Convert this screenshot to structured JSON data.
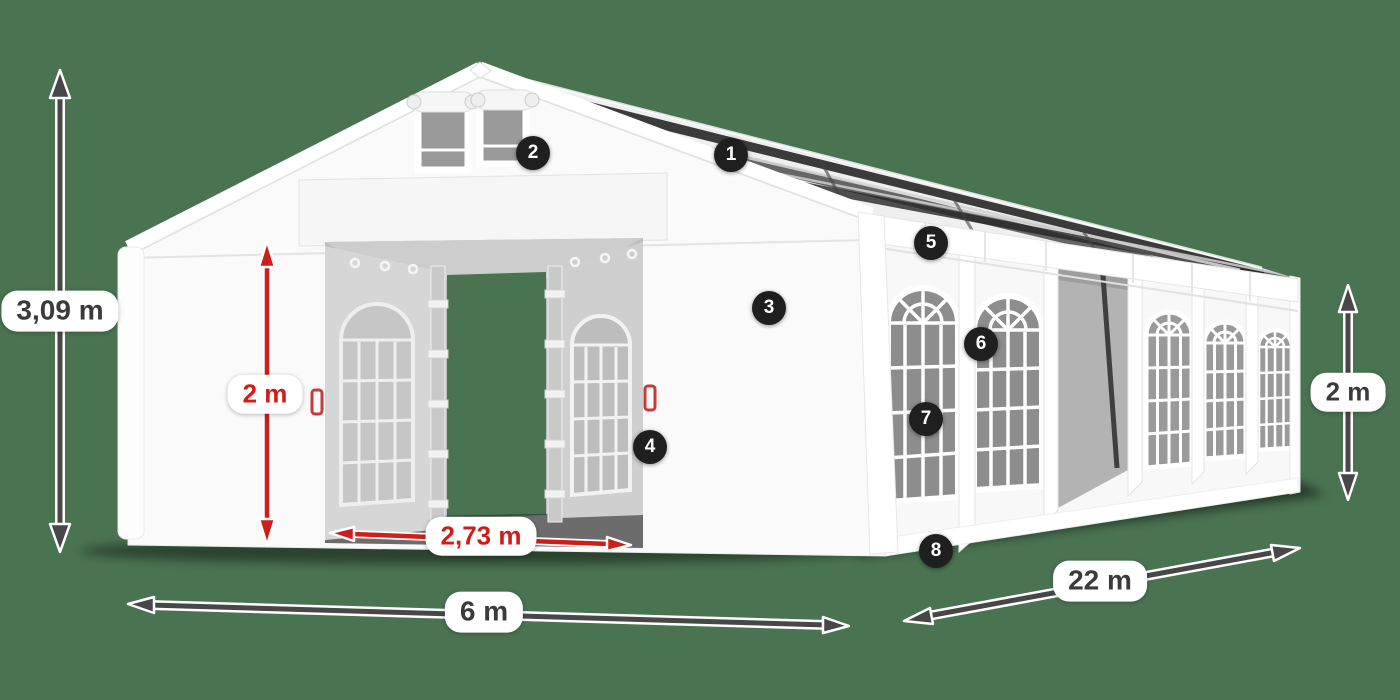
{
  "scene": {
    "background_color": "#4a7351",
    "arrow_dark_color": "#474747",
    "arrow_red_color": "#cf1d1a",
    "callout_bg_color": "#1f1f1f"
  },
  "dimension_labels": {
    "total_height": "3,09 m",
    "entrance_height": "2 m",
    "entrance_width": "2,73 m",
    "width": "6 m",
    "length": "22 m",
    "side_height": "2 m"
  },
  "callouts": [
    "1",
    "2",
    "3",
    "4",
    "5",
    "6",
    "7",
    "8"
  ]
}
